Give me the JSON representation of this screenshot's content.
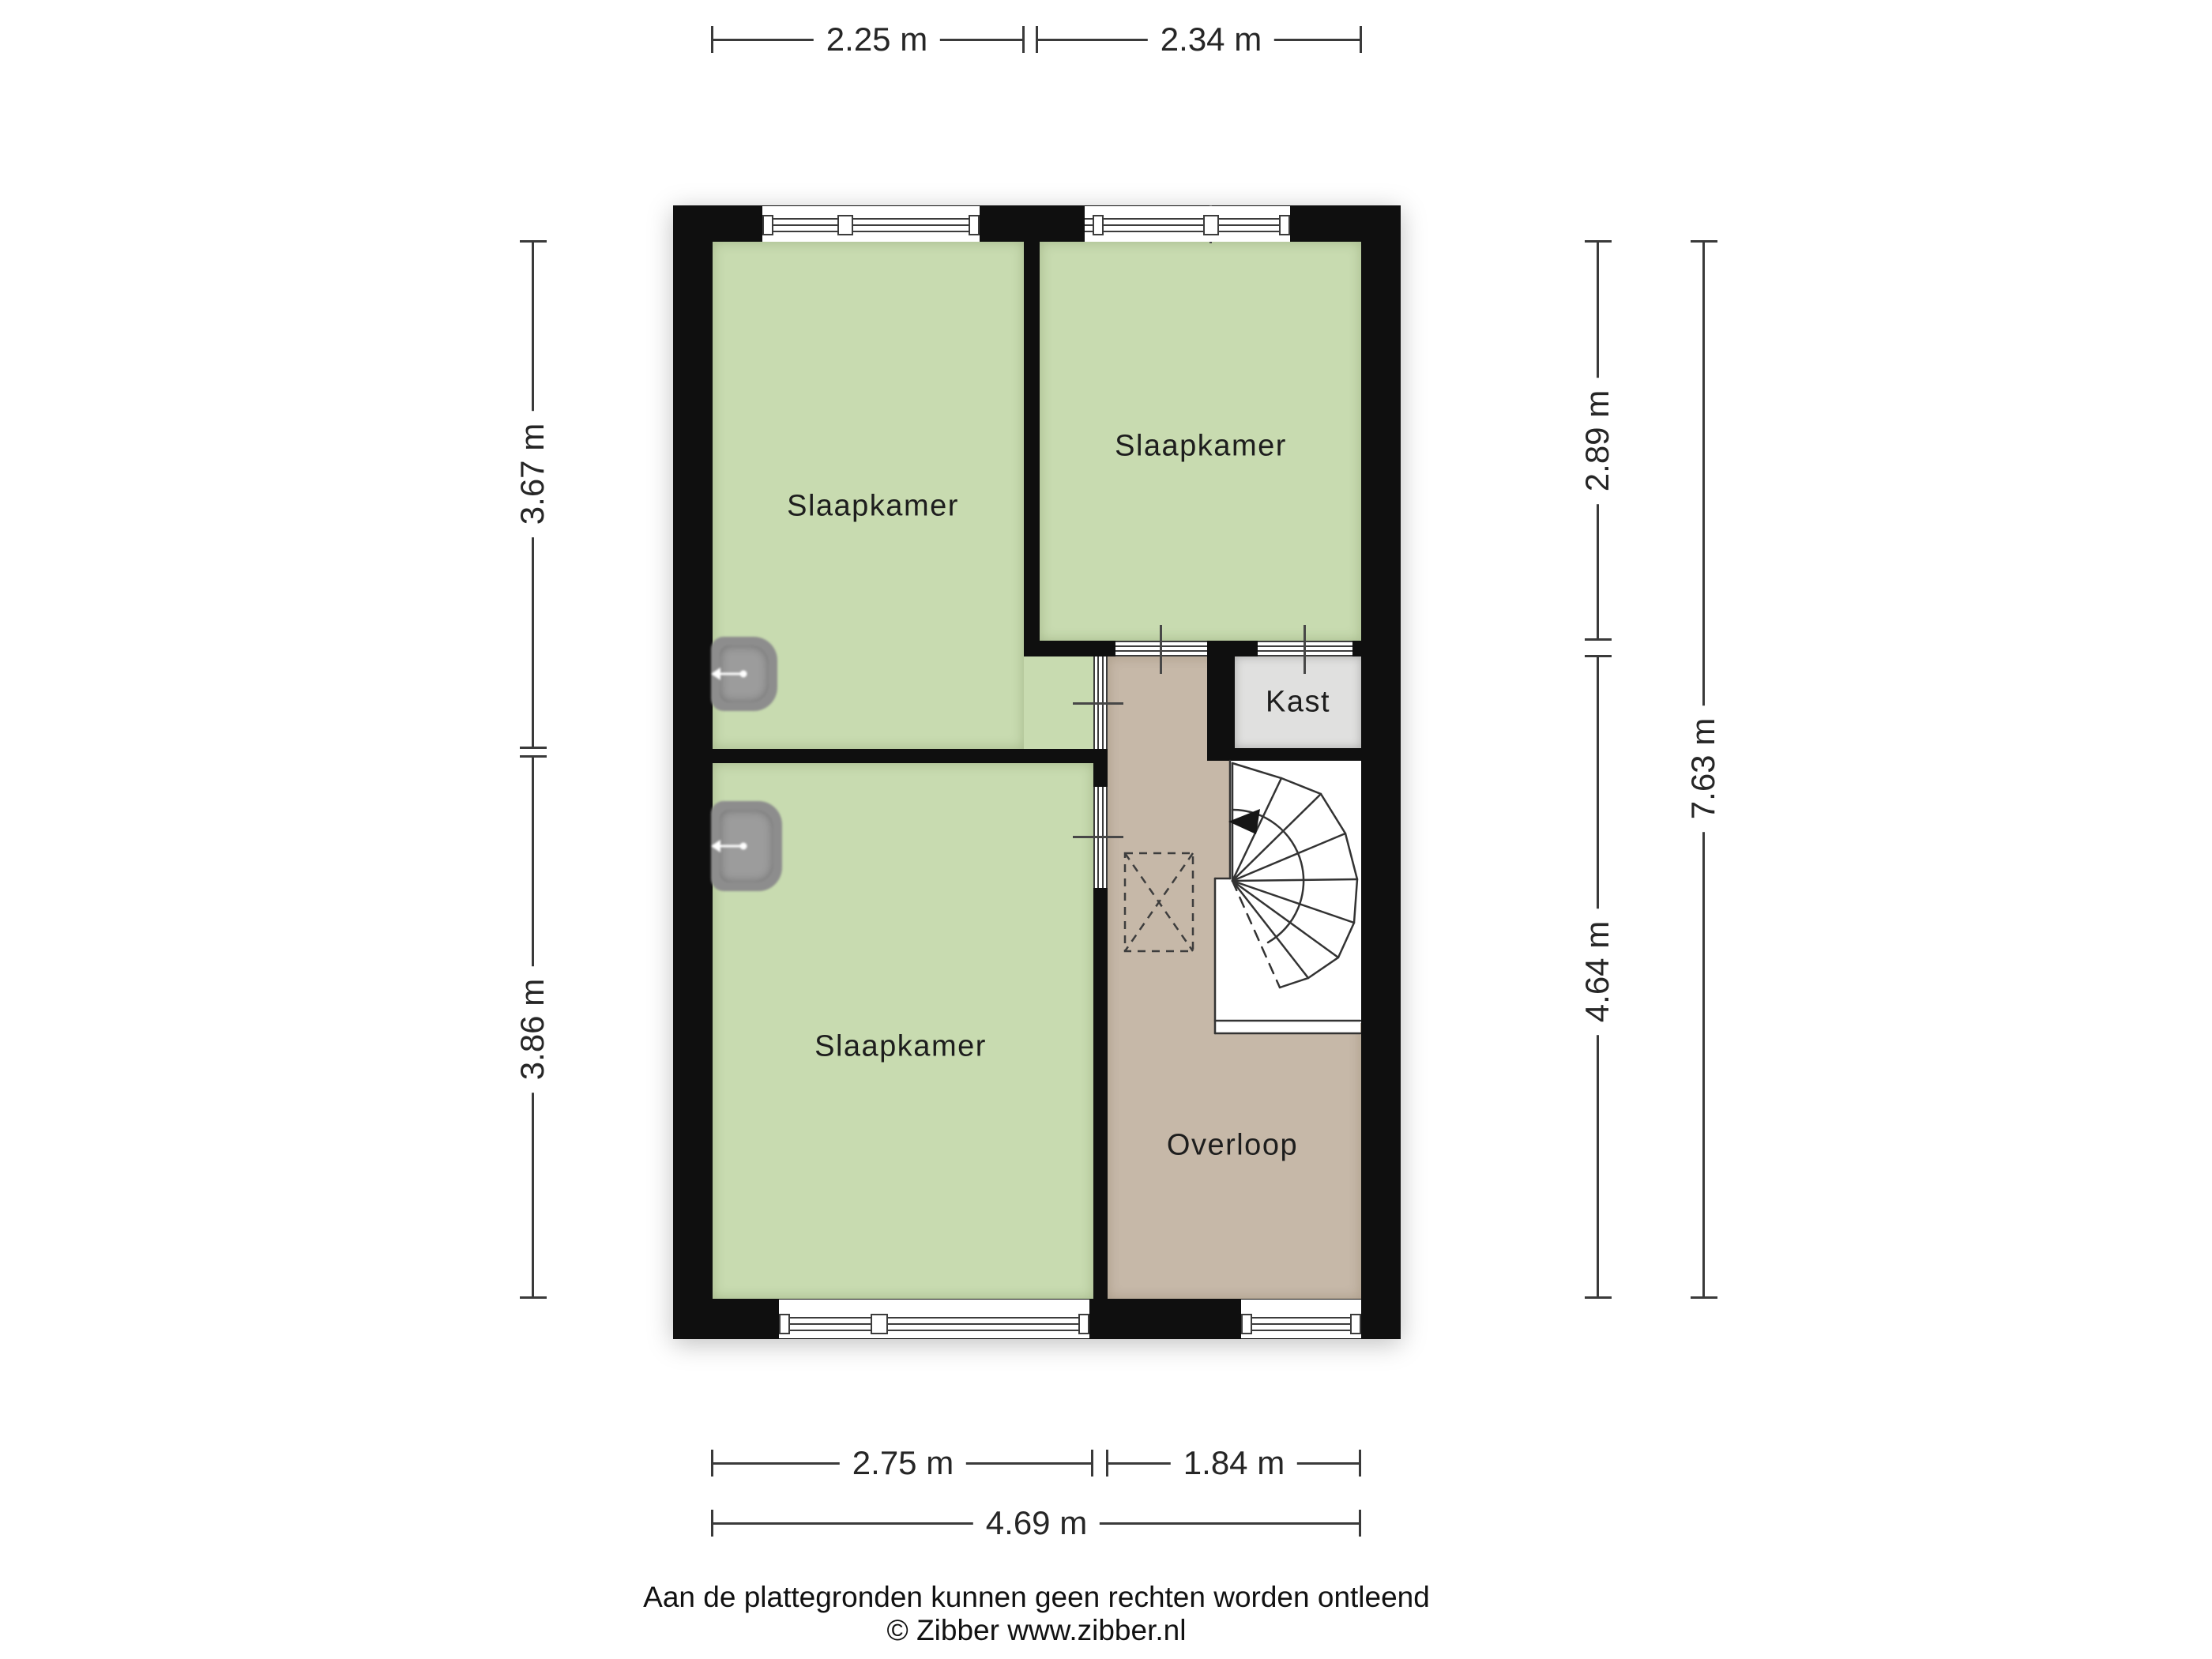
{
  "plan": {
    "title_hint": "floor plan upper storey",
    "rooms": {
      "bedroom_top_left": {
        "label": "Slaapkamer"
      },
      "bedroom_top_right": {
        "label": "Slaapkamer"
      },
      "bedroom_bottom_left": {
        "label": "Slaapkamer"
      },
      "closet": {
        "label": "Kast"
      },
      "landing": {
        "label": "Overloop"
      }
    },
    "colors": {
      "room_green": "#c8dbb0",
      "landing_brown": "#c6b8a8",
      "closet_grey": "#e0e0df",
      "wall_black": "#0f0f0f",
      "stairs_white": "#ffffff",
      "dimension_line": "#3a3a3a"
    },
    "dimensions": {
      "top": [
        {
          "label": "2.25 m"
        },
        {
          "label": "2.34 m"
        }
      ],
      "left": [
        {
          "label": "3.67 m"
        },
        {
          "label": "3.86 m"
        }
      ],
      "right_inner": [
        {
          "label": "2.89 m"
        },
        {
          "label": "4.64 m"
        }
      ],
      "right_outer": {
        "label": "7.63 m"
      },
      "bottom_inner": [
        {
          "label": "2.75 m"
        },
        {
          "label": "1.84 m"
        }
      ],
      "bottom_outer": {
        "label": "4.69 m"
      }
    }
  },
  "footer": {
    "disclaimer": "Aan de plattegronden kunnen geen rechten worden ontleend",
    "credit": "© Zibber www.zibber.nl"
  }
}
